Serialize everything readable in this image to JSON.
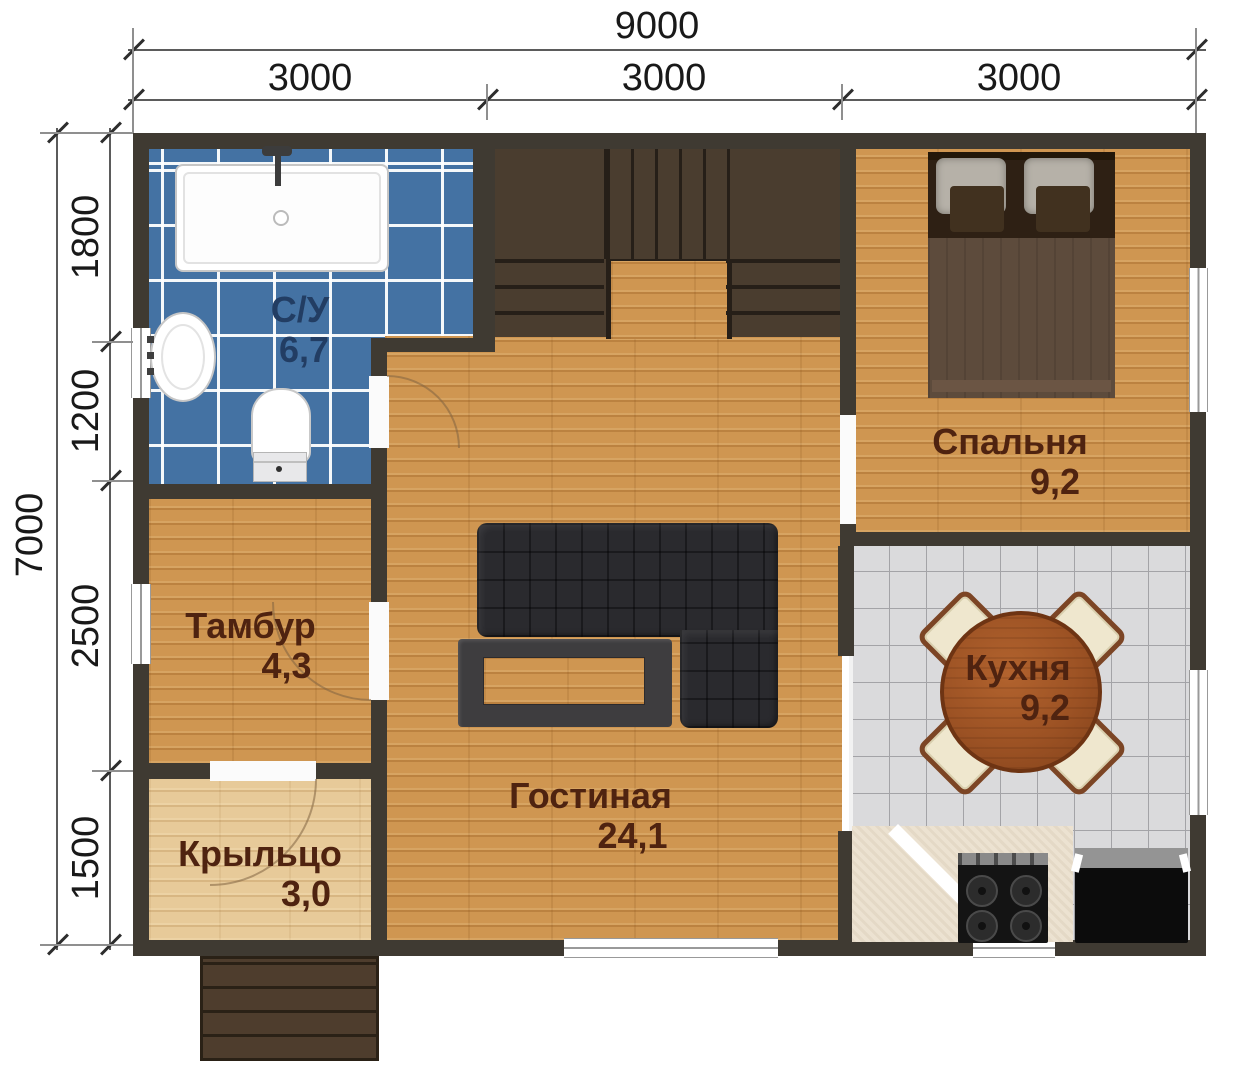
{
  "dimensions": {
    "top": {
      "overall": "9000",
      "segments": [
        "3000",
        "3000",
        "3000"
      ]
    },
    "left": {
      "overall": "7000",
      "segments": [
        "1800",
        "1200",
        "2500",
        "1500"
      ]
    }
  },
  "rooms": [
    {
      "id": "bathroom",
      "name": "С/У",
      "area": "6,7"
    },
    {
      "id": "bedroom",
      "name": "Спальня",
      "area": "9,2"
    },
    {
      "id": "kitchen",
      "name": "Кухня",
      "area": "9,2"
    },
    {
      "id": "living",
      "name": "Гостиная",
      "area": "24,1"
    },
    {
      "id": "vestibule",
      "name": "Тамбур",
      "area": "4,3"
    },
    {
      "id": "porch",
      "name": "Крыльцо",
      "area": "3,0"
    }
  ],
  "colors": {
    "wall": "#3f3a32",
    "wood_floor": "#cf9651",
    "porch_floor": "#e7ca99",
    "bathroom_tile": "#4472a3",
    "kitchen_tile": "#dadadc",
    "stairs": "#4a3d2f",
    "sofa": "#2a2a2e",
    "kitchen_table": "#9c5224",
    "room_label": "#4f2310",
    "bathroom_label": "#223d63",
    "dimension_text": "#191919"
  }
}
